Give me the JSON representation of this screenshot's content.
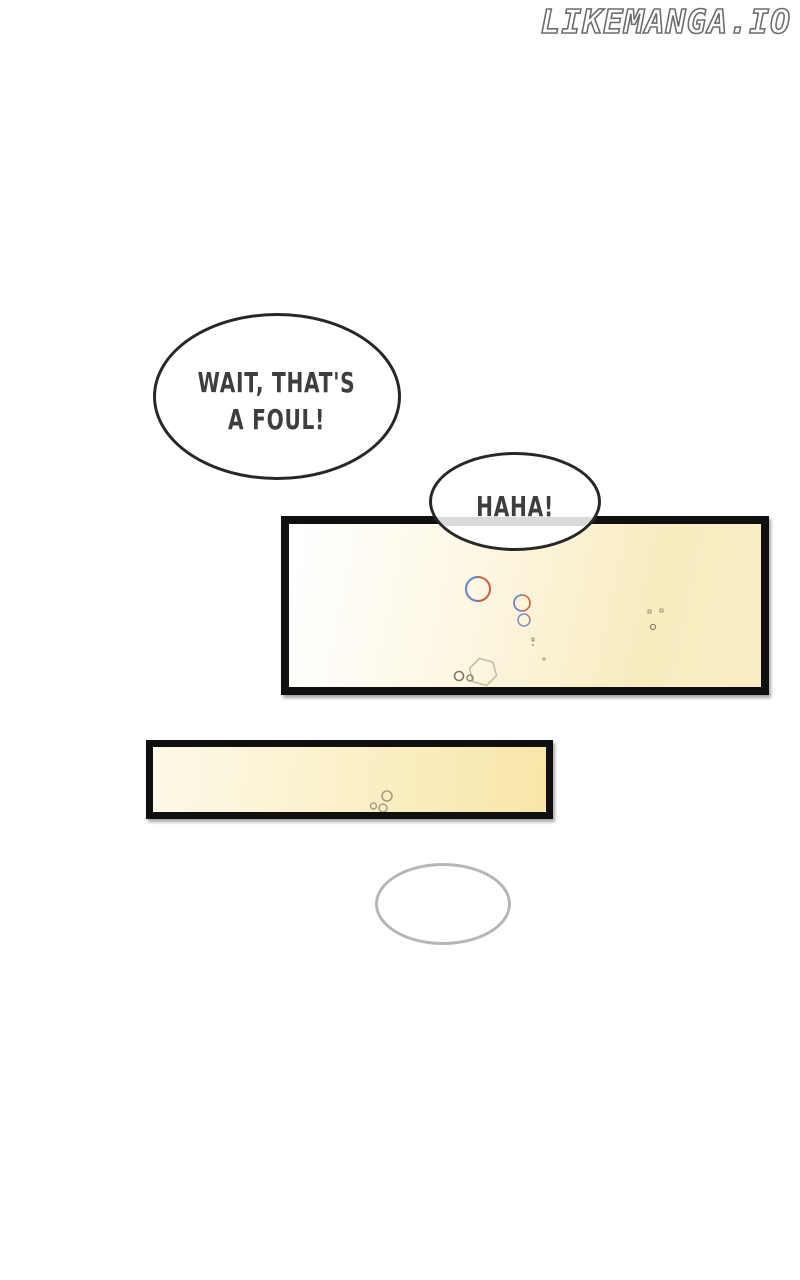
{
  "watermark": {
    "text": "LIKEMANGA.IO",
    "fill_color": "#ffffff",
    "outline_color": "#6d6d6d"
  },
  "speech": {
    "foul": {
      "line1": "WAIT, THAT'S",
      "line2": "A FOUL!"
    },
    "haha": {
      "text": "HAHA!"
    },
    "empty_bubble_text": ""
  },
  "panels": {
    "panel1": {
      "border_color": "#101010",
      "gradient_start": "#ffffff",
      "gradient_end": "#faeec6",
      "content": "close-up of pale yellow drink with fizz bubbles"
    },
    "panel2": {
      "border_color": "#101010",
      "gradient_start": "#fdf9e9",
      "gradient_end": "#f8e6a8",
      "content": "narrow close-up of pale yellow drink with fizz bubbles"
    }
  },
  "decor_colors": {
    "fizz_blue": "#6e86cc",
    "fizz_red": "#c95f41",
    "fizz_tan": "#c6bca0",
    "fizz_dark_tan": "#8d8577",
    "empty_bubble_stroke": "#b6b6b6",
    "text_color": "#3e3e3e",
    "overlap_stripe": "#dadada"
  }
}
